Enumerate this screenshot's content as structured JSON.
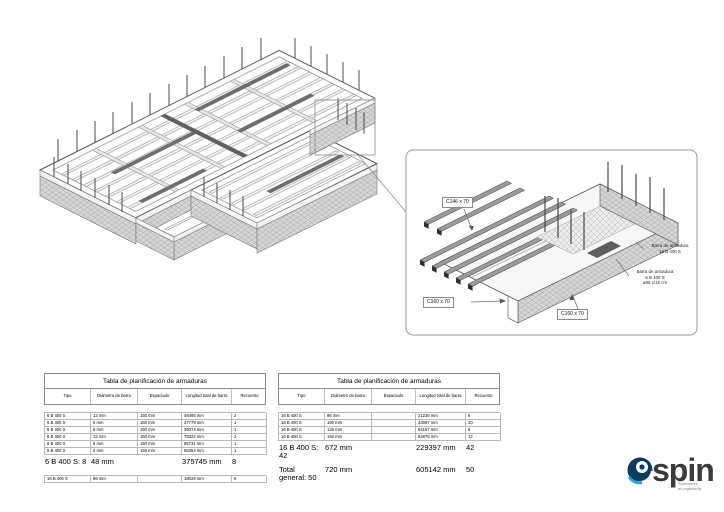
{
  "detail": {
    "labels": {
      "c146": "C146 x 70",
      "c160_left": "C160 x 70",
      "c160_bottom": "C160 x 70",
      "rebar16_line1": "Barra de armadura",
      "rebar16_line2": "16 B 400 S",
      "rebar6_line1": "Barra de armadura",
      "rebar6_line2": "6 B 400 S",
      "rebar6_line3": "ø06 c/15 cm"
    }
  },
  "tables": [
    {
      "title": "Tabla de planificación de armaduras",
      "headers": [
        "Tipo",
        "Diámetro de barra",
        "Espaciado",
        "Longitud total de barra",
        "Recuento"
      ],
      "rows": [
        [
          "6 B 400 S",
          "12 mm",
          "150 mm",
          "48485 mm",
          "2"
        ],
        [
          "6 B 400 S",
          "6 mm",
          "150 mm",
          "37779 mm",
          "1"
        ],
        [
          "6 B 400 S",
          "6 mm",
          "150 mm",
          "39074 mm",
          "1"
        ],
        [
          "6 B 400 S",
          "12 mm",
          "150 mm",
          "78322 mm",
          "2"
        ],
        [
          "6 B 400 S",
          "6 mm",
          "150 mm",
          "85731 mm",
          "1"
        ],
        [
          "6 B 400 S",
          "6 mm",
          "150 mm",
          "86353 mm",
          "1"
        ]
      ],
      "summary": {
        "label": "6 B 400 S: 8",
        "diameter": "48 mm",
        "length": "375745 mm",
        "count": "8"
      },
      "extra_row": [
        "16 B 400 S",
        "96 mm",
        "",
        "18029 mm",
        "6"
      ]
    },
    {
      "title": "Tabla de planificación de armaduras",
      "headers": [
        "Tipo",
        "Diámetro de barra",
        "Espaciado",
        "Longitud total de barra",
        "Recuento"
      ],
      "rows": [
        [
          "16 B 400 S",
          "96 mm",
          "",
          "21236 mm",
          "6"
        ],
        [
          "16 B 400 S",
          "160 mm",
          "",
          "43097 mm",
          "10"
        ],
        [
          "16 B 400 S",
          "128 mm",
          "",
          "54157 mm",
          "8"
        ],
        [
          "16 B 400 S",
          "192 mm",
          "",
          "92876 mm",
          "12"
        ]
      ],
      "summaries": [
        {
          "label": "16 B 400 S: 42",
          "diameter": "672 mm",
          "length": "229397 mm",
          "count": "42"
        },
        {
          "label": "Total general: 50",
          "diameter": "720 mm",
          "length": "605142 mm",
          "count": "50"
        }
      ]
    }
  ],
  "logo": {
    "name": "spin",
    "tagline1": "Soluciones",
    "tagline2": "en ingeniería",
    "accent_blue": "#2f9fd8",
    "navy": "#0d3b5e",
    "text_color": "#3b3b3a"
  }
}
